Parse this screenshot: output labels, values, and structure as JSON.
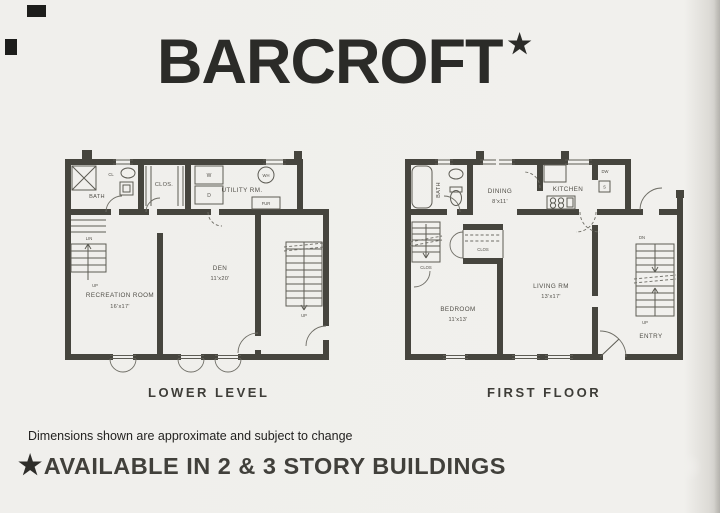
{
  "title": {
    "text": "BARCROFT",
    "star": "★"
  },
  "lower": {
    "caption": "LOWER LEVEL",
    "labels": {
      "bath": "BATH",
      "cl": "CL",
      "lin": "LIN",
      "clos": "CLOS.",
      "utility": "UTILITY RM.",
      "washer": "W",
      "dryer": "D",
      "water_heater": "WH",
      "furnace": "FUR",
      "up_left": "UP",
      "up_right": "UP",
      "rec_room": "RECREATION ROOM",
      "rec_dims": "16'x17'",
      "den": "DEN",
      "den_dims": "11'x20'"
    }
  },
  "first": {
    "caption": "FIRST FLOOR",
    "labels": {
      "bath": "BATH",
      "dining": "DINING",
      "dining_dims": "8'x11'",
      "kitchen": "KITCHEN",
      "dishwasher": "DW",
      "sink": "S",
      "clos_left": "CLOS",
      "clos_center": "CLOS",
      "bedroom": "BEDROOM",
      "bedroom_dims": "11'x13'",
      "living": "LIVING RM",
      "living_dims": "13'x17'",
      "entry": "ENTRY",
      "down": "DN",
      "up": "UP"
    }
  },
  "footer": {
    "disclaimer": "Dimensions shown are approximate and subject to change",
    "star": "★",
    "availability": "AVAILABLE IN 2 & 3 STORY BUILDINGS"
  },
  "colors": {
    "paper": "#f0efec",
    "wall": "#46453e",
    "ink": "#2b2b28",
    "thin_line": "#5d5c54"
  }
}
